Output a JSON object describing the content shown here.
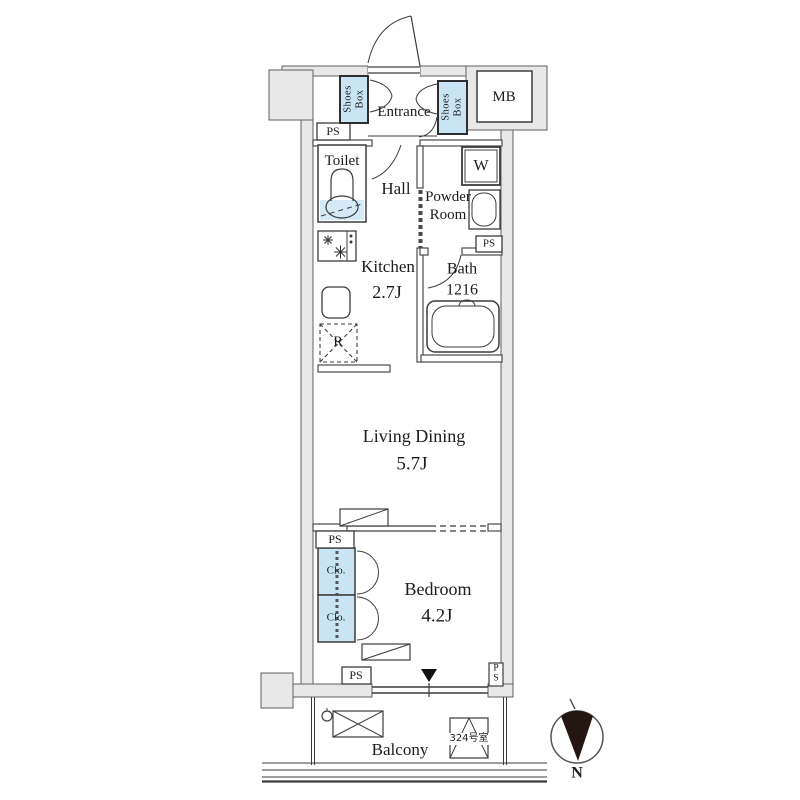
{
  "colors": {
    "wall_fill": "#e8e8e8",
    "wall_stroke": "#5f5f5f",
    "line": "#3c3c3c",
    "fixture_blue": "#c9e5f4",
    "water_blue": "#d4eaf6",
    "text": "#1c1c1c",
    "needle_black": "#241712"
  },
  "rooms": {
    "entrance": {
      "label": "Entrance"
    },
    "hall": {
      "label": "Hall"
    },
    "toilet": {
      "label": "Toilet"
    },
    "powder_room": {
      "label": "Powder\nRoom"
    },
    "kitchen": {
      "label": "Kitchen",
      "size": "2.7J"
    },
    "bath": {
      "label": "Bath",
      "size": "1216"
    },
    "living_dining": {
      "label": "Living Dining",
      "size": "5.7J"
    },
    "bedroom": {
      "label": "Bedroom",
      "size": "4.2J"
    },
    "balcony": {
      "label": "Balcony"
    }
  },
  "fixtures": {
    "shoes_box": {
      "label": "Shoes\nBox"
    },
    "meter_box": {
      "label": "MB"
    },
    "washing_machine": {
      "label": "W"
    },
    "refrigerator": {
      "label": "R"
    },
    "pipe_space": {
      "label": "PS"
    },
    "pipe_space_vertical": {
      "label": "P\nS"
    },
    "closet": {
      "label": "Clo."
    },
    "room_number": {
      "label": "324号室"
    }
  },
  "compass": {
    "label": "N"
  }
}
